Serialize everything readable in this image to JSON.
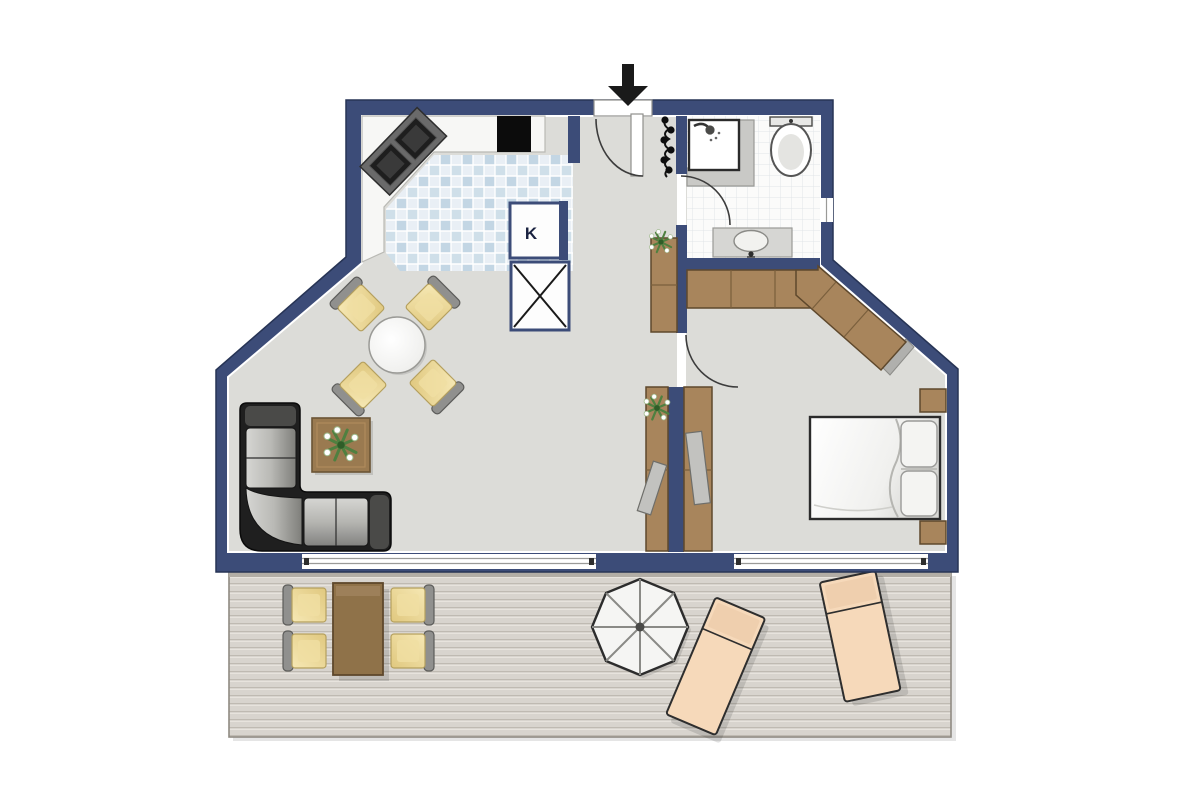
{
  "scene": {
    "type": "floor-plan",
    "description": "apartment floor plan with terrace"
  },
  "labels": {
    "fridge": "K"
  },
  "palette": {
    "wall": "#3c4c78",
    "wallEdge": "#273455",
    "floor": "#dcdcd8",
    "counter": "#f7f7f5",
    "tileA": "#c3d6e4",
    "tileB": "#cfdfe9",
    "tileBg": "#e9eff5",
    "bathFloor": "#fbfbfa",
    "bathGrid": "#e0e4e8",
    "wood": "#a8855c",
    "woodDark": "#5e482c",
    "terraceTable": "#8f7249",
    "deck": "#d8d4ce",
    "deckLine": "#bfbab2",
    "deckHi": "#e7e3dd",
    "chairYellow": "#f0dfa2",
    "chairYellowDeep": "#e0c87f",
    "chairBack": "#90908e",
    "sofaFrame": "#1f1f1f",
    "sofaCushion": "#c6c6c3",
    "lounger": "#f6d9ba",
    "plantGreen": "#4f8040",
    "grayCounter": "#c9c9c6",
    "black": "#111111"
  },
  "icons": [
    "entrance-arrow-icon",
    "entrance-door",
    "coat-rack-icon",
    "kitchen-counter",
    "stove-icon",
    "cooktop-sink-icon",
    "fridge-box",
    "storage-box",
    "dining-table",
    "dining-chair",
    "sofa",
    "coffee-table",
    "plant-icon",
    "shower-icon",
    "toilet-icon",
    "washbasin-icon",
    "wardrobe",
    "hall-closet",
    "tv-icon",
    "double-bed",
    "nightstand",
    "window",
    "terrace-deck",
    "terrace-table",
    "terrace-chair",
    "parasol-icon",
    "sun-lounger"
  ]
}
